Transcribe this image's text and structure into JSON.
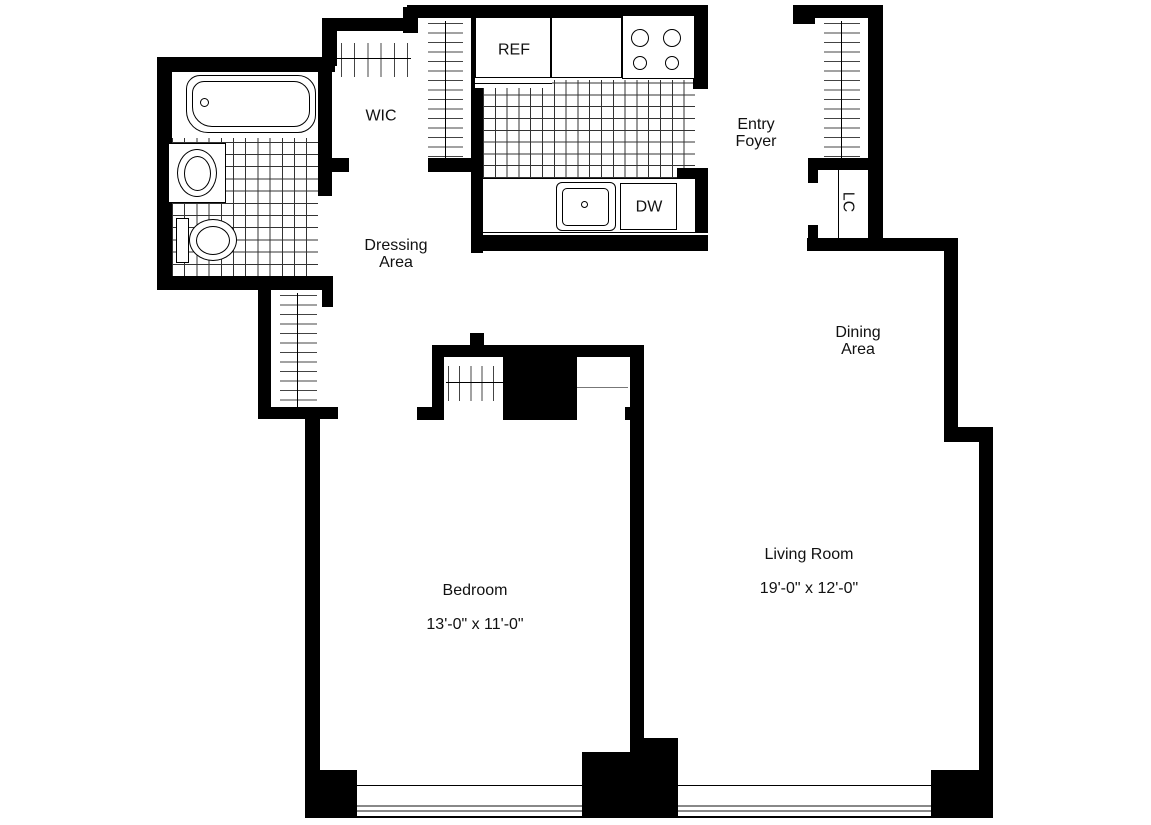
{
  "floor_plan": {
    "labels": {
      "wic": "WIC",
      "dressing_area": "Dressing\nArea",
      "entry_foyer": "Entry\nFoyer",
      "dining_area": "Dining\nArea",
      "linen_closet": "LC",
      "refrigerator": "REF",
      "dishwasher": "DW",
      "living_room": {
        "name": "Living Room",
        "dimensions": "19'-0\" x 12'-0\""
      },
      "bedroom": {
        "name": "Bedroom",
        "dimensions": "13'-0\" x 11'-0\""
      }
    },
    "colors": {
      "walls": "#000000",
      "background": "#ffffff",
      "tile_lines": "#333333",
      "hatch_lines": "#444444",
      "window_glazing": "#888888",
      "text": "#111111"
    }
  }
}
